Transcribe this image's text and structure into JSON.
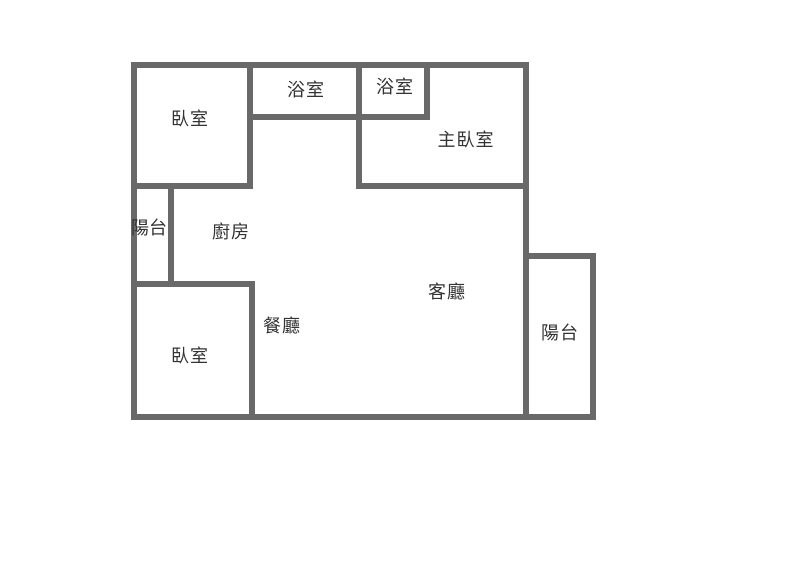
{
  "diagram_type": "apartment-floor-plan",
  "colors": {
    "wall": "#696969",
    "text": "#333333",
    "background": "#ffffff"
  },
  "rooms": {
    "bedroom_top_left": {
      "label": "臥室"
    },
    "bathroom_1": {
      "label": "浴室"
    },
    "bathroom_2": {
      "label": "浴室"
    },
    "master_bedroom": {
      "label": "主臥室"
    },
    "balcony_left": {
      "label": "陽台"
    },
    "kitchen": {
      "label": "廚房"
    },
    "dining_room": {
      "label": "餐廳"
    },
    "living_room": {
      "label": "客廳"
    },
    "bedroom_bottom_left": {
      "label": "臥室"
    },
    "balcony_right": {
      "label": "陽台"
    }
  }
}
